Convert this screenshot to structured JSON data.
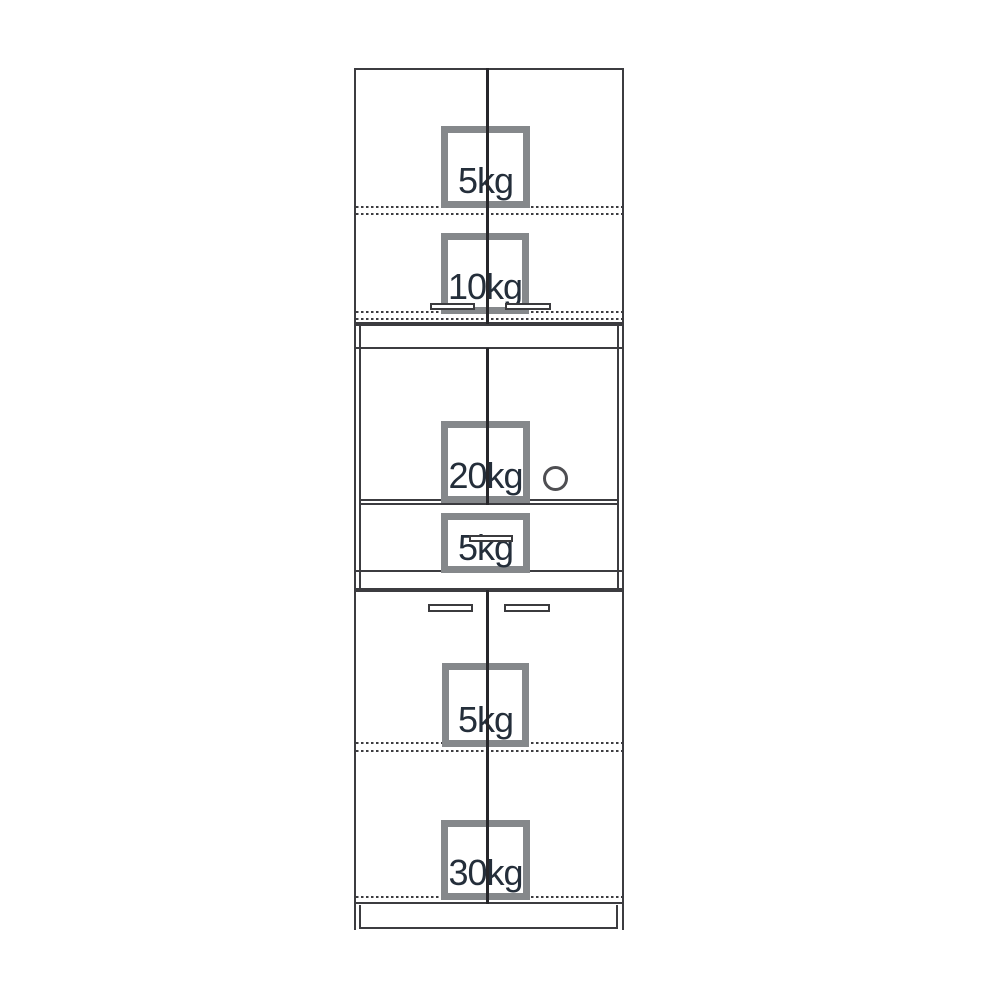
{
  "diagram": {
    "type": "furniture-load-capacity-drawing",
    "units": {
      "top_cabinet": {
        "badges": [
          {
            "label": "5kg"
          },
          {
            "label": "10kg"
          }
        ]
      },
      "middle_unit": {
        "badges": [
          {
            "label": "20kg"
          },
          {
            "label": "5kg"
          }
        ]
      },
      "bottom_cabinet": {
        "badges": [
          {
            "label": "5kg"
          },
          {
            "label": "30kg"
          }
        ]
      }
    },
    "colors": {
      "line": "#3c3c40",
      "door_gap_line": "#26262a",
      "badge_border": "#85888b",
      "badge_text": "#242e3a",
      "background": "#ffffff"
    }
  }
}
